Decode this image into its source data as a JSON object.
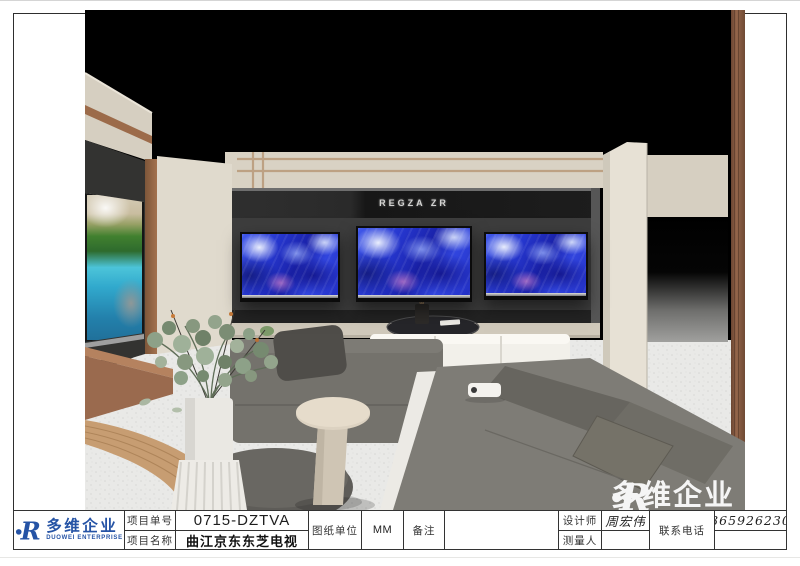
{
  "title_block": {
    "project_no_label": "项目单号",
    "project_no": "0715-DZTVA",
    "project_name_label": "项目名称",
    "project_name": "曲江京东东芝电视",
    "drawing_unit_label": "图纸单位",
    "drawing_unit": "MM",
    "remark_label": "备注",
    "remark": "",
    "designer_label": "设计师",
    "designer": "周宏伟",
    "surveyor_label": "测量人",
    "surveyor": "",
    "phone_label": "联系电话",
    "phone": "13659262305"
  },
  "logo": {
    "company_cn": "多维企业",
    "company_en": "DUOWEI ENTERPRISE",
    "mark": "R",
    "color": "#2553a5"
  },
  "render": {
    "tv_brand_sign": "REGZA ZR",
    "watermark_text": "多维企业",
    "watermark_mark": "R",
    "colors": {
      "wall_cream": "#d9d2c4",
      "wood_trim": "#9c6b4a",
      "tv_wall_dark": "#3d3d3d",
      "screen_blue": "#2637cf",
      "lake_cyan": "#31a9cd",
      "floor_terrazzo": "#e9e9e7"
    }
  }
}
